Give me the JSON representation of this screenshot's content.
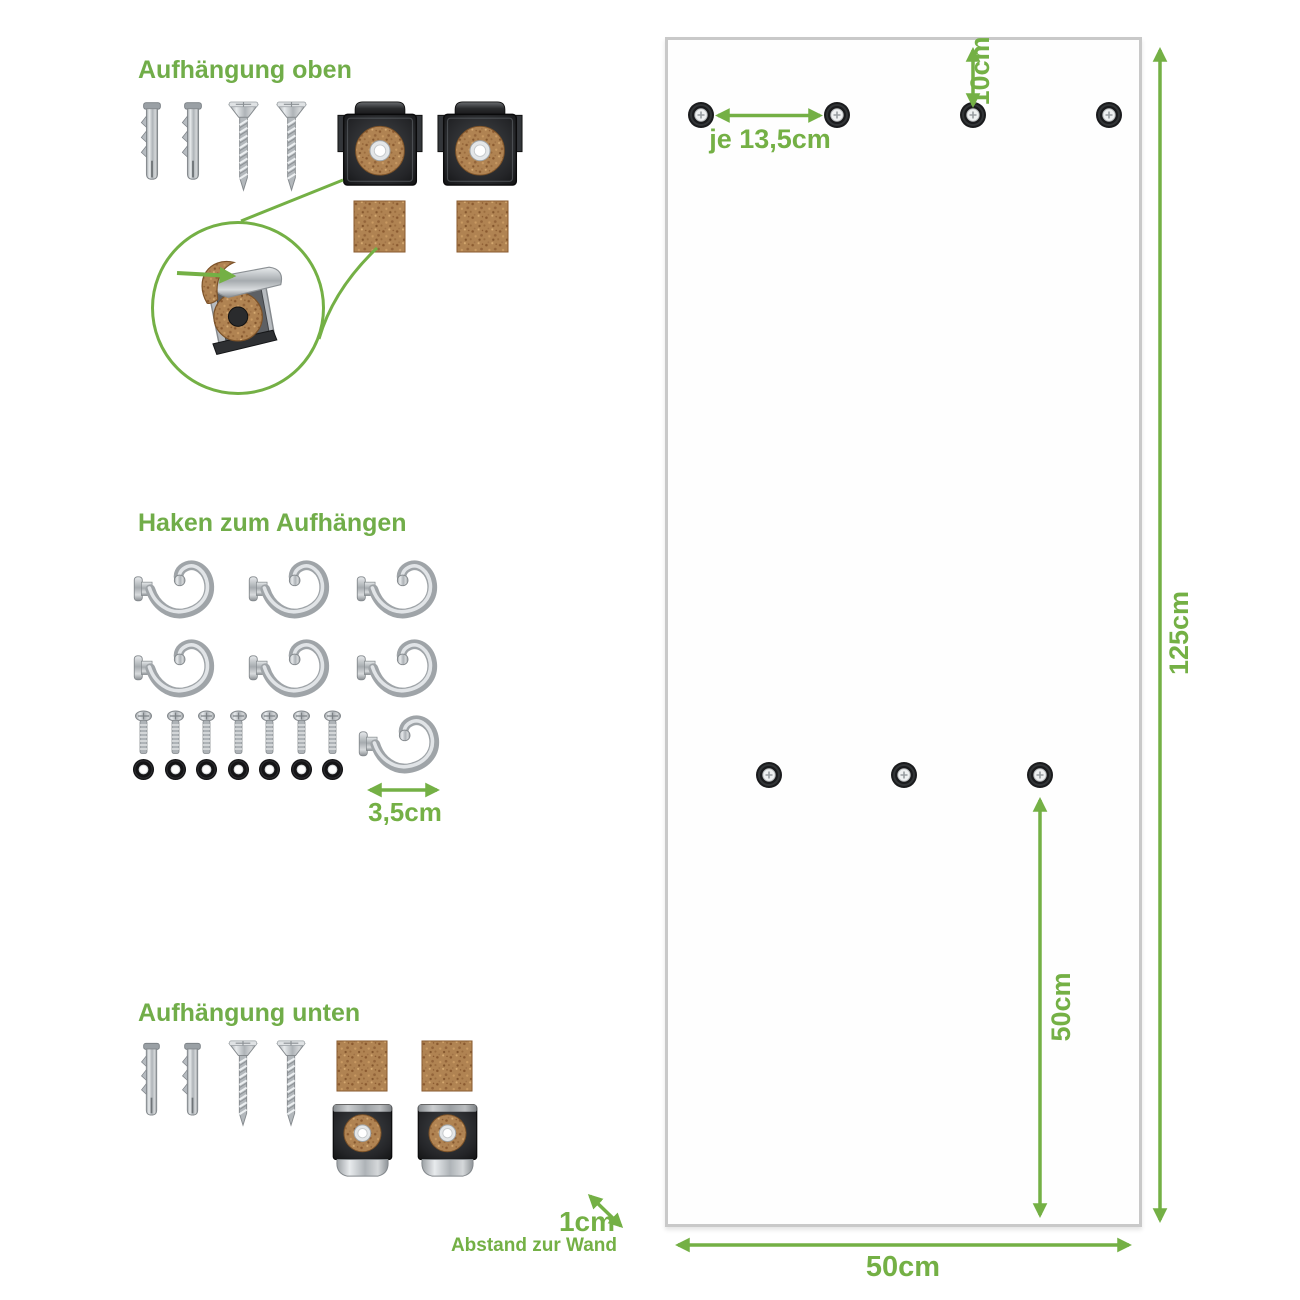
{
  "accent_color": "#74b045",
  "panel_border_color": "#c9c9c9",
  "cork_color": "#b08352",
  "sections": {
    "top_mount": {
      "title": "Aufhängung oben",
      "parts": {
        "wall_plugs": 2,
        "screws": 2,
        "mirror_clips": 2,
        "cork_pads": 2
      },
      "detail": "clip-with-cork-strip-magnified"
    },
    "hooks": {
      "title": "Haken zum Aufhängen",
      "hooks": 7,
      "bolts": 7,
      "washers": 7,
      "hook_width_label": "3,5cm"
    },
    "bottom_mount": {
      "title": "Aufhängung unten",
      "parts": {
        "wall_plugs": 2,
        "screws": 2,
        "cork_pads": 2,
        "mirror_clips": 2
      }
    }
  },
  "panel": {
    "top_holes": 4,
    "middle_holes": 3,
    "labels": {
      "top_hole_spacing": "je 13,5cm",
      "top_edge_offset": "10cm",
      "height": "125cm",
      "mid_hole_to_bottom": "50cm",
      "width": "50cm",
      "wall_distance_value": "1cm",
      "wall_distance_caption": "Abstand zur Wand"
    }
  }
}
